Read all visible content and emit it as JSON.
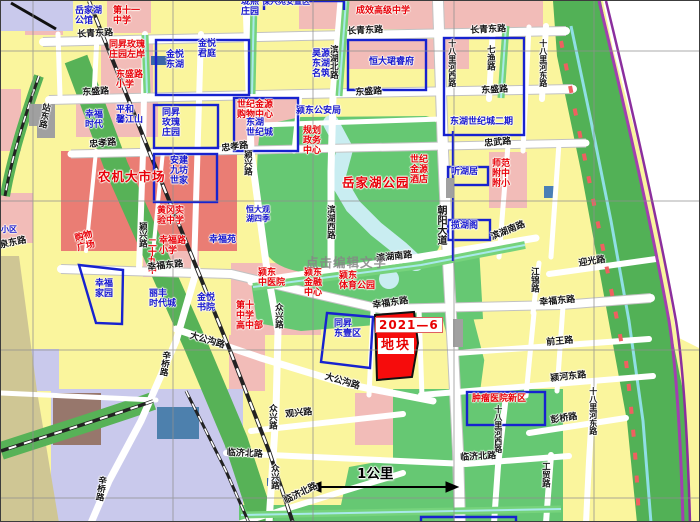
{
  "map": {
    "title": "颍东区规划地图",
    "scale_label": "1公里",
    "watermark": "点击编辑文字",
    "parcel": {
      "id": "2021—6",
      "name": "地块"
    },
    "colors": {
      "parcel_red": "#f60c0c",
      "boundary_blue": "#1722cf",
      "park_green": "#66c873",
      "greenbelt": "#52b156",
      "block_yellow": "#faf59d",
      "block_pink": "#f2bcb8",
      "facility_red": "#ea7d74",
      "water_cyan": "#c9edf1",
      "expressway_purple": "#a23fb0",
      "lavender": "#c9c9ec",
      "road_white": "#ffffff"
    },
    "labels": [
      {
        "t": "岳家湖\n公馆"
      },
      {
        "t": "第十一\n中学"
      },
      {
        "t": "长青东路"
      },
      {
        "t": "长青东路"
      },
      {
        "t": "长青东路"
      },
      {
        "t": "同昇玫瑰\n庄园左岸"
      },
      {
        "t": "金悦\n东湖"
      },
      {
        "t": "金悦\n君庭"
      },
      {
        "t": "东盛路\n小学"
      },
      {
        "t": "珑熙\n庄园"
      },
      {
        "t": "保兴苑安置区"
      },
      {
        "t": "成效高级中学"
      },
      {
        "t": "昊源\n东湖\n名筑"
      },
      {
        "t": "恒大珺睿府"
      },
      {
        "t": "东盛路"
      },
      {
        "t": "东盛路"
      },
      {
        "t": "东盛路"
      },
      {
        "t": "幸福\n时代"
      },
      {
        "t": "平和\n馨江山"
      },
      {
        "t": "同昇\n玫瑰\n庄园"
      },
      {
        "t": "世纪金源\n购物中心"
      },
      {
        "t": "东湖\n世纪城"
      },
      {
        "t": "颍东公安局"
      },
      {
        "t": "东湖世纪城二期"
      },
      {
        "t": "忠孝路"
      },
      {
        "t": "忠孝路"
      },
      {
        "t": "忠武路"
      },
      {
        "t": "安建\n九坊\n世家"
      },
      {
        "t": "规划\n政务\n中心"
      },
      {
        "t": "岳家湖公园"
      },
      {
        "t": "世纪\n金源\n酒店"
      },
      {
        "t": "师范\n附中\n附小"
      },
      {
        "t": "听湖居"
      },
      {
        "t": "揽湖阁"
      },
      {
        "t": "农机大市场"
      },
      {
        "t": "黄冈实\n验中学"
      },
      {
        "t": "购物\n广场"
      },
      {
        "t": "幸福路\n小学"
      },
      {
        "t": "二十九中"
      },
      {
        "t": "幸福苑"
      },
      {
        "t": "恒大观\n湖四季"
      },
      {
        "t": "滨湖北路"
      },
      {
        "t": "滨湖西路"
      },
      {
        "t": "朝阳大道"
      },
      {
        "t": "颍兴路"
      },
      {
        "t": "颍兴路"
      },
      {
        "t": "站东路"
      },
      {
        "t": "小区"
      },
      {
        "t": "泉东路"
      },
      {
        "t": "幸福东路"
      },
      {
        "t": "幸福东路"
      },
      {
        "t": "幸福东路"
      },
      {
        "t": "滨湖南路"
      },
      {
        "t": "滨湖南路"
      },
      {
        "t": "颍东\n中医院"
      },
      {
        "t": "颍东\n金融\n中心"
      },
      {
        "t": "颍东\n体育公园"
      },
      {
        "t": "第十\n中学\n高中部"
      },
      {
        "t": "同昇\n东壹区"
      },
      {
        "t": "幸福\n家园"
      },
      {
        "t": "丽丰\n时代城"
      },
      {
        "t": "金悦\n书院"
      },
      {
        "t": "大公沟路"
      },
      {
        "t": "大公沟路"
      },
      {
        "t": "辛桥路"
      },
      {
        "t": "辛桥路"
      },
      {
        "t": "众兴路"
      },
      {
        "t": "众兴路"
      },
      {
        "t": "众兴路"
      },
      {
        "t": "迎光路"
      },
      {
        "t": "江锦路"
      },
      {
        "t": "前王路"
      },
      {
        "t": "颍河东路"
      },
      {
        "t": "彭桥路"
      },
      {
        "t": "十八里河东路"
      },
      {
        "t": "七渔路"
      },
      {
        "t": "十八里河西路"
      },
      {
        "t": "十八里河东路"
      },
      {
        "t": "十八里河西路"
      },
      {
        "t": "工贸路"
      },
      {
        "t": "临济北路"
      },
      {
        "t": "临济北路"
      },
      {
        "t": "临济北路"
      },
      {
        "t": "观兴路"
      },
      {
        "t": "肿瘤医院新区"
      }
    ]
  }
}
